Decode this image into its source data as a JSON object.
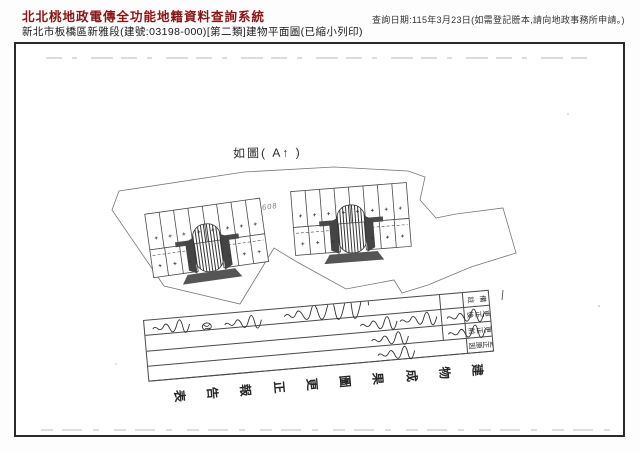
{
  "header": {
    "system_title": "北北桃地政電傳全功能地籍資料查詢系統",
    "query_info": "查詢日期:115年3月23日(如需登記謄本,請向地政事務所申請。)",
    "subtitle": "新北市板橋區新雅段(建號:03198-000)[第二類]建物平面圖(已縮小列印)"
  },
  "plan": {
    "figure_note": "如圖( A↑ )",
    "parcel_label": "608"
  },
  "correction_form": {
    "row_headers": [
      "備註",
      "更正後",
      "更正前",
      "更正原因"
    ],
    "title": "建物成果圖更正報告表"
  },
  "colors": {
    "title_red": "#8b1414",
    "scan_ink": "#4a4a4a",
    "hatch_dark": "#3a3a3a"
  }
}
